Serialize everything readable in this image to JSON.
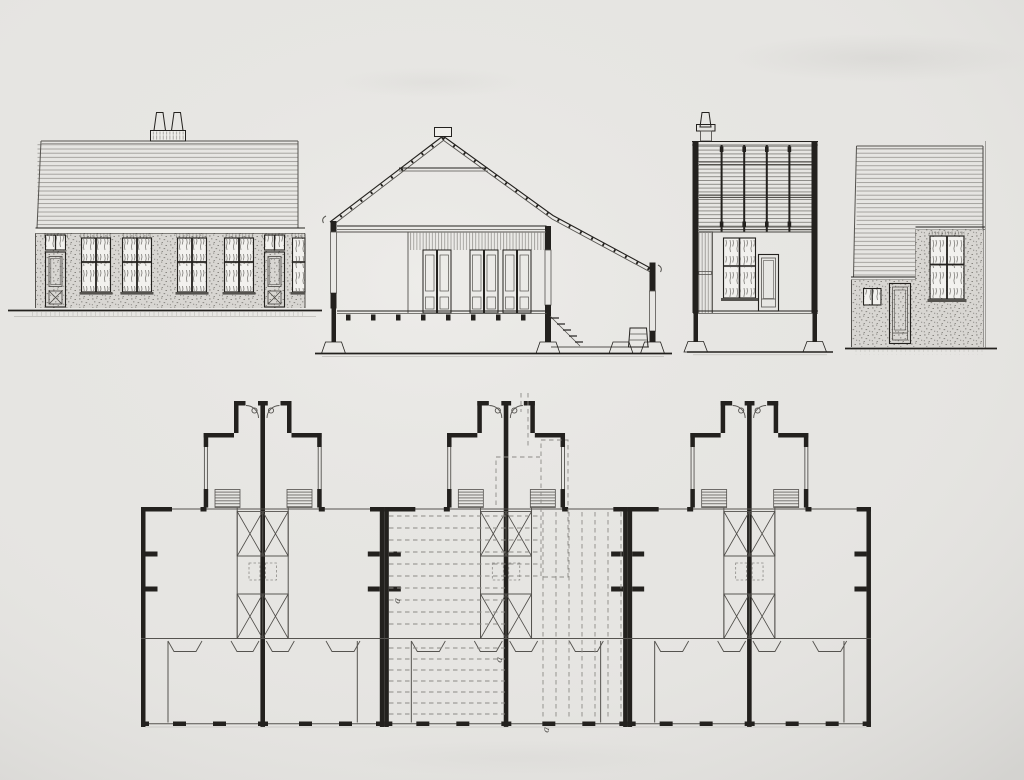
{
  "sheet": {
    "kind": "measured architectural drawing, ink on paper",
    "views_count": 4,
    "plan_units_count": 3
  },
  "colors": {
    "paper": "#e6e5e2",
    "paperLight": "#efeeea",
    "paperShade": "#d2d1ce",
    "ink": "#23211e",
    "inkSoft": "#55534f",
    "lineGray": "#8f8d89",
    "pane": "#f2f1ee",
    "brick": "#d8d6d2",
    "curtain": "#807e7a",
    "dash": "#8c8a86",
    "marker": "#4a4844"
  },
  "plan": {
    "section_markers": [
      "a",
      "a",
      "a"
    ]
  }
}
